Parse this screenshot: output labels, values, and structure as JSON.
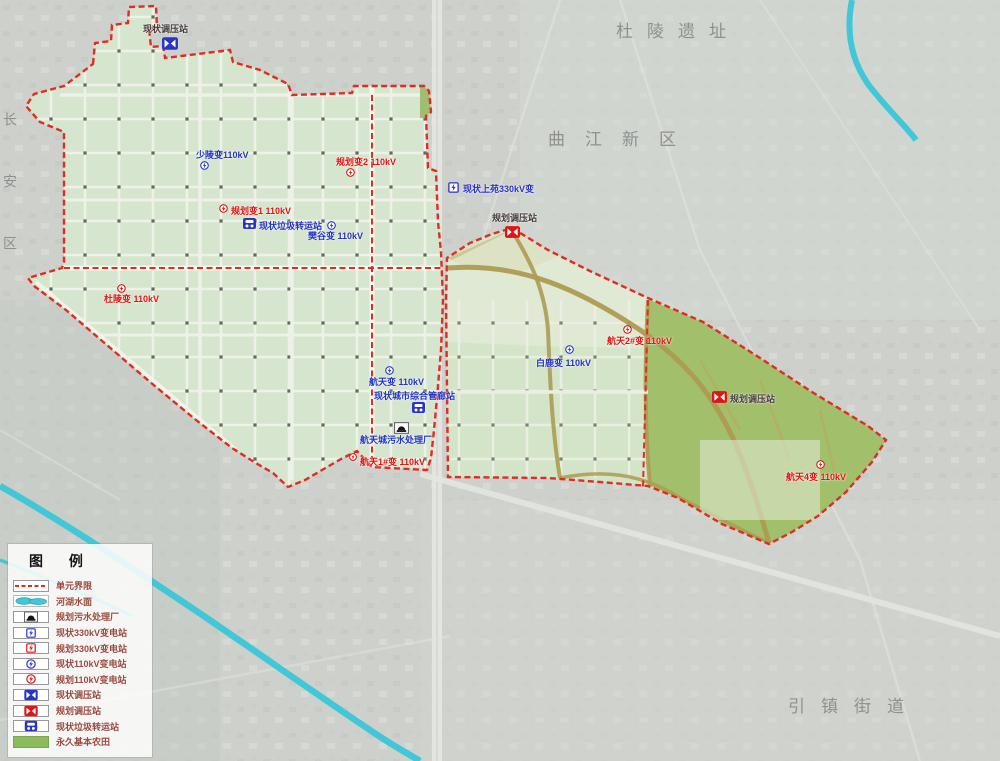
{
  "region_labels": {
    "duling": "杜陵遗址",
    "qujiang": "曲江新区",
    "yinzhen": "引镇街道",
    "changan": "长安区",
    "river": "潏河"
  },
  "facilities": [
    {
      "text": "现状调压站"
    },
    {
      "text": "少陵变110kV"
    },
    {
      "text": "规划变2 110kV"
    },
    {
      "text": "规划变1 110kV"
    },
    {
      "text": "现状垃圾转运站"
    },
    {
      "text": "樊谷变 110kV"
    },
    {
      "text": "现状上苑330kV变"
    },
    {
      "text": "规划调压站"
    },
    {
      "text": "杜陵变 110kV"
    },
    {
      "text": "航天变 110kV"
    },
    {
      "text": "现状城市综合管廊站"
    },
    {
      "text": "航天城污水处理厂"
    },
    {
      "text": "航天1#变 110kV"
    },
    {
      "text": "白鹿变 110kV"
    },
    {
      "text": "航天2#变 110kV"
    },
    {
      "text": "规划调压站"
    },
    {
      "text": "航天4变 110kV"
    }
  ],
  "legend": {
    "title": "图 例",
    "items": [
      {
        "label": "单元界限"
      },
      {
        "label": "河湖水面"
      },
      {
        "label": "规划污水处理厂"
      },
      {
        "label": "现状330kV变电站"
      },
      {
        "label": "规划330kV变电站"
      },
      {
        "label": "现状110kV变电站"
      },
      {
        "label": "规划110kV变电站"
      },
      {
        "label": "现状调压站"
      },
      {
        "label": "规划调压站"
      },
      {
        "label": "现状垃圾转运站"
      },
      {
        "label": "永久基本农田"
      }
    ]
  },
  "colors": {
    "boundary_red": "#e02c22",
    "existing_blue": "#2a35c8",
    "planned_red": "#e01414",
    "area_green": "#d6e5cd",
    "farmland_green": "#a2c06b",
    "water_cyan": "#42c7d8",
    "road_tan": "#ad9b52"
  }
}
